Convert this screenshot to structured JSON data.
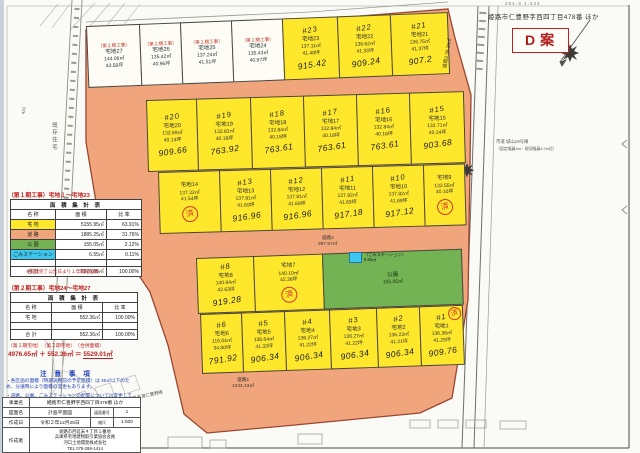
{
  "sheet": {
    "corner_note": "281-3 1:444",
    "title": "姫路市仁豊野字西四丁目478番 ほか",
    "plan_label": "D案"
  },
  "map": {
    "right_road_label_1": "市道 城山19号線",
    "right_road_label_2": "（認定幅員4m・現況幅員4.2m位）",
    "left_area_label": "既存住宅",
    "left_road_no": "431",
    "left_road_name": "姫路市道仁豊野線",
    "roads": [
      {
        "name": "道路1",
        "area": "1344.43㎡"
      },
      {
        "name": "道路2",
        "area": "397.57㎡"
      },
      {
        "name": "道路3",
        "area": "38.35㎡"
      }
    ],
    "park": {
      "name": "公園",
      "area": "155.05㎡"
    },
    "trash": {
      "label": "（ごみステーション）",
      "area": "6.55㎡"
    },
    "sold_mark": "済",
    "phase2_label": "（第２期工事）"
  },
  "lots": [
    {
      "id": 1,
      "name": "宅地1",
      "area": "136.36㎡",
      "tsubo": "41.25坪",
      "phase": 1,
      "hw": "#1",
      "price": "909.76",
      "sold": true
    },
    {
      "id": 2,
      "name": "宅地2",
      "area": "136.23㎡",
      "tsubo": "41.21坪",
      "phase": 1,
      "hw": "#2",
      "price": "906.34"
    },
    {
      "id": 3,
      "name": "宅地3",
      "area": "136.27㎡",
      "tsubo": "41.22坪",
      "phase": 1,
      "hw": "#3",
      "price": "906.34"
    },
    {
      "id": 4,
      "name": "宅地4",
      "area": "136.27㎡",
      "tsubo": "41.22坪",
      "phase": 1,
      "hw": "#4",
      "price": "906.34"
    },
    {
      "id": 5,
      "name": "宅地5",
      "area": "136.64㎡",
      "tsubo": "41.33坪",
      "phase": 1,
      "hw": "#5",
      "price": "906.34"
    },
    {
      "id": 6,
      "name": "宅地6",
      "area": "115.04㎡",
      "tsubo": "34.80坪",
      "phase": 1,
      "hw": "#6",
      "price": "791.92"
    },
    {
      "id": 7,
      "name": "宅地7",
      "area": "140.10㎡",
      "tsubo": "42.38坪",
      "phase": 1,
      "sold": true
    },
    {
      "id": 8,
      "name": "宅地8",
      "area": "140.94㎡",
      "tsubo": "42.63坪",
      "phase": 1,
      "hw": "#8",
      "price": "919.28"
    },
    {
      "id": 9,
      "name": "宅地9",
      "area": "132.55㎡",
      "tsubo": "40.10坪",
      "phase": 1,
      "sold": true
    },
    {
      "id": 10,
      "name": "宅地10",
      "area": "137.82㎡",
      "tsubo": "41.69坪",
      "phase": 1,
      "hw": "#10",
      "price": "917.12"
    },
    {
      "id": 11,
      "name": "宅地11",
      "area": "137.82㎡",
      "tsubo": "41.69坪",
      "phase": 1,
      "hw": "#11",
      "price": "917.18"
    },
    {
      "id": 12,
      "name": "宅地12",
      "area": "137.81㎡",
      "tsubo": "41.69坪",
      "phase": 1,
      "hw": "#12",
      "price": "916.96"
    },
    {
      "id": 13,
      "name": "宅地13",
      "area": "137.81㎡",
      "tsubo": "41.69坪",
      "phase": 1,
      "hw": "#13",
      "price": "916.96"
    },
    {
      "id": 14,
      "name": "宅地14",
      "area": "137.32㎡",
      "tsubo": "41.54坪",
      "phase": 1,
      "sold": true
    },
    {
      "id": 15,
      "name": "宅地15",
      "area": "132.71㎡",
      "tsubo": "40.14坪",
      "phase": 1,
      "hw": "#15",
      "price": "903.68"
    },
    {
      "id": 16,
      "name": "宅地16",
      "area": "132.84㎡",
      "tsubo": "40.18坪",
      "phase": 1,
      "hw": "#16",
      "price": "763.61"
    },
    {
      "id": 17,
      "name": "宅地17",
      "area": "132.84㎡",
      "tsubo": "40.18坪",
      "phase": 1,
      "hw": "#17",
      "price": "763.61"
    },
    {
      "id": 18,
      "name": "宅地18",
      "area": "132.84㎡",
      "tsubo": "40.18坪",
      "phase": 1,
      "hw": "#18",
      "price": "763.61"
    },
    {
      "id": 19,
      "name": "宅地19",
      "area": "132.83㎡",
      "tsubo": "40.18坪",
      "phase": 1,
      "hw": "#19",
      "price": "763.92"
    },
    {
      "id": 20,
      "name": "宅地20",
      "area": "132.69㎡",
      "tsubo": "40.14坪",
      "phase": 1,
      "hw": "#20",
      "price": "909.66"
    },
    {
      "id": 21,
      "name": "宅地21",
      "area": "136.75㎡",
      "tsubo": "41.37坪",
      "phase": 1,
      "hw": "#21",
      "price": "907.2"
    },
    {
      "id": 22,
      "name": "宅地22",
      "area": "136.62㎡",
      "tsubo": "41.33坪",
      "phase": 1,
      "hw": "#22",
      "price": "909.24"
    },
    {
      "id": 23,
      "name": "宅地23",
      "area": "137.11㎡",
      "tsubo": "41.48坪",
      "phase": 1,
      "hw": "#23",
      "price": "915.42"
    },
    {
      "id": 24,
      "name": "宅地24",
      "area": "135.43㎡",
      "tsubo": "40.97坪",
      "phase": 2
    },
    {
      "id": 25,
      "name": "宅地25",
      "area": "137.24㎡",
      "tsubo": "41.51坪",
      "phase": 2
    },
    {
      "id": 26,
      "name": "宅地26",
      "area": "135.42㎡",
      "tsubo": "40.96坪",
      "phase": 2
    },
    {
      "id": 27,
      "name": "宅地27",
      "area": "144.06㎡",
      "tsubo": "43.58坪",
      "phase": 2
    }
  ],
  "table1": {
    "title": "（第１期工事）宅地１～宅地23",
    "header": "面 積 集 計 表",
    "cols": [
      "名 称",
      "面 積",
      "比 率"
    ],
    "rows": [
      {
        "name": "宅 地",
        "color": "#ffe72b",
        "area": "5155.95㎡",
        "ratio": "63.91%"
      },
      {
        "name": "道 路",
        "color": "#f0a57c",
        "area": "1885.25㎡",
        "ratio": "31.76%"
      },
      {
        "name": "公 園",
        "color": "#74b354",
        "area": "155.05㎡",
        "ratio": "2.12%"
      },
      {
        "name": "ごみステーション",
        "color": "#3cc7ef",
        "area": "6.55㎡",
        "ratio": "0.11%"
      }
    ],
    "total": {
      "name": "合 計",
      "area": "6876.85㎡",
      "ratio": "100.00%"
    }
  },
  "note1": "※開発完了公告日より１年間経過後",
  "table2": {
    "title": "（第２期工事）宅地24～宅地27",
    "header": "面 積 集 計 表",
    "cols": [
      "名 称",
      "面 積",
      "比 率"
    ],
    "rows": [
      {
        "name": "宅 地",
        "color": "#ffffff",
        "area": "552.36㎡",
        "ratio": "100.00%"
      }
    ],
    "total": {
      "name": "合 計",
      "area": "552.36㎡",
      "ratio": "100.00%"
    }
  },
  "merge": {
    "line1": "（第１期宅地）　（第２期宅地）　（合併面積）",
    "prefix": "4976.65㎡ ＋ 552.36㎡ ＝ ",
    "sum": "5529.01㎡"
  },
  "cautions": {
    "title": "注 意 事 項",
    "items": [
      "・各区画の面積（時期調整前の予定面積）は 35㎡以下のため、分譲時により面積の変更もあります。",
      "・道路、公園、ごみステーションの配置については変更していないが、道路幅員については変更になる可能性があります。"
    ]
  },
  "titleblock": {
    "rows": [
      {
        "label": "事業名",
        "value": "姫路市仁豊野字西四丁目478番 ほか"
      },
      {
        "label": "図面名",
        "value": "計画平面図",
        "xlabel": "図面番号",
        "xvalue": "1"
      },
      {
        "label": "作成日",
        "value": "令和２年12月25日",
        "xlabel": "縮尺",
        "xvalue": "1:500"
      },
      {
        "label": "作成者",
        "value": "姫路市西延末４丁目１番地\n兵庫県宅地建物取引業協会会員\n河口土地開発株式会社\nTEL 079-298-1414"
      }
    ]
  }
}
